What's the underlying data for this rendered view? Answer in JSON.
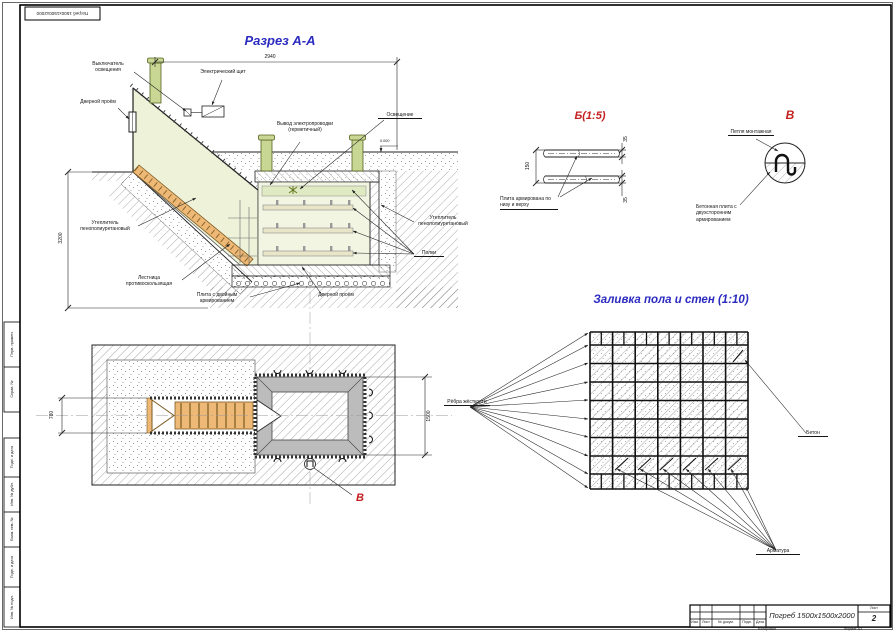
{
  "frame": {
    "top_stamp": "Погреб 1500х1500х2000",
    "side_fields": [
      "Перв. примен.",
      "Справ. №",
      "Подп. и дата",
      "Инв. № дубл.",
      "Взам. инв. №",
      "Подп. и дата",
      "Инв. № подл."
    ],
    "title_block": {
      "cols": [
        "Изм.",
        "Лист",
        "№ докум.",
        "Подп.",
        "Дата"
      ],
      "doc_title": "Погреб 1500х1500х2000",
      "sheet_label": "Лист",
      "sheet_number": "2",
      "copied": "Копировал",
      "format": "Формат A3"
    }
  },
  "section": {
    "title": "Разрез А-А",
    "dims": {
      "width": "2940",
      "height": "3200",
      "level": "0.000"
    },
    "labels": {
      "switch": "Выключатель освещения",
      "panel": "Электрический щит",
      "door_left": "Дверной проём",
      "wiring": "Вывод электропроводки (герметичный)",
      "lighting": "Освещение",
      "insulation_left": "Утеплитель пенополиуретановый",
      "insulation_right": "Утеплитель пенополиуретановый",
      "stairs": "Лестница противоскользящая",
      "slab": "Плита с двойным армированием",
      "door_bottom": "Дверной проём",
      "shelves": "Полки"
    }
  },
  "detail_b": {
    "title": "Б(1:5)",
    "dim_thickness": "150",
    "dim_cover_top": "35",
    "dim_cover_bottom": "35",
    "label": "Плита армирована по низу и верху"
  },
  "detail_v": {
    "title": "В",
    "label_loop": "Петля монтажная",
    "label_slab": "Бетонная плита с двухсторонним армированием"
  },
  "plan": {
    "dim_door": "780",
    "dim_room": "1500",
    "marker": "В"
  },
  "pour": {
    "title": "Заливка пола и стен (1:10)",
    "label_ribs": "Рёбра жёсткости",
    "label_concrete": "Бетон",
    "label_rebar": "Арматура"
  },
  "colors": {
    "accent_blue": "#2b2bc0",
    "accent_red": "#c42020",
    "wall_green": "#edf2d8",
    "stair_orange": "#eeb877",
    "wall_gray": "#bcbcbc"
  }
}
